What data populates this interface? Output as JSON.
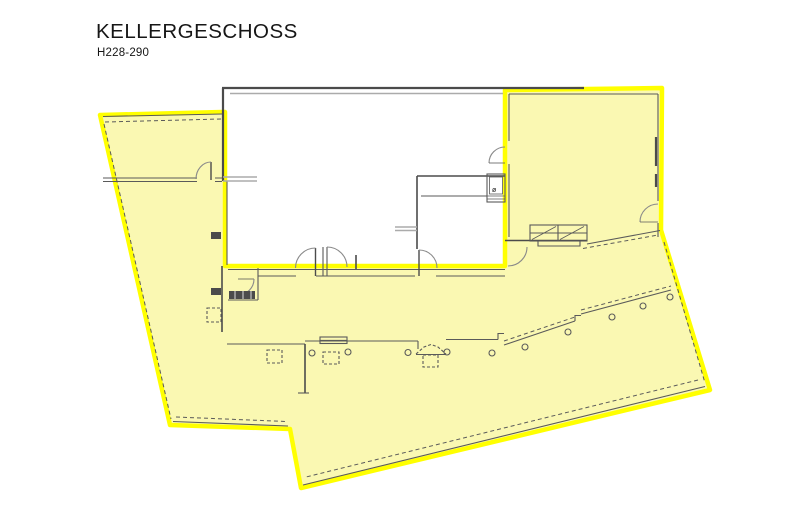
{
  "header": {
    "title": "KELLERGESCHOSS",
    "subtitle": "H228-290"
  },
  "plan": {
    "type": "architectural-floorplan",
    "floor": "Kellergeschoss (basement)",
    "labels": {
      "elevator_symbol": "ø"
    },
    "highlighted_area": "building perimeter, left wing, right stair room and lower hall highlighted in yellow; central main room left white",
    "features": [
      "main-room",
      "stair-room-right",
      "stairs",
      "elevator-shaft",
      "corridor",
      "columns",
      "ramp-diagonal",
      "door-swings",
      "dashed-duct-boxes"
    ]
  },
  "theme": {
    "paper": "#ffffff",
    "ink": "#161616",
    "highlight": "#ffff00",
    "area": "#faf8b2",
    "wall": "#4b4b4b",
    "wallthin": "#5a5a5a",
    "walllight": "#ababab",
    "door": "#8a8a8a"
  }
}
